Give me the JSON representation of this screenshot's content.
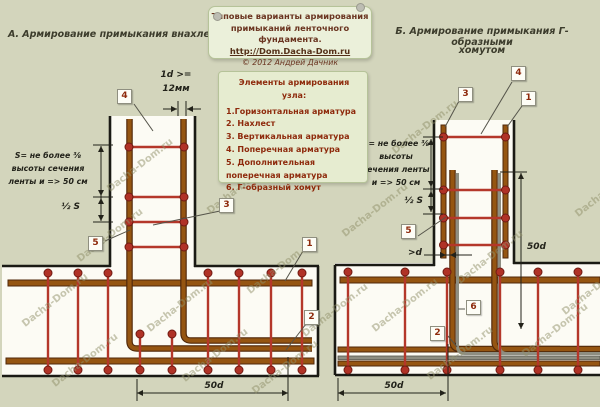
{
  "page": {
    "watermark": "Dacha-Dom.ru"
  },
  "note": {
    "line1": "Типовые варианты армирования",
    "line2": "примыканий ленточного фундамента.",
    "link": "http://Dom.Dacha-Dom.ru",
    "copyright": "© 2012 Андрей Дачник"
  },
  "titles": {
    "left": "А. Армирование примыкания внахлест",
    "right_line1": "Б. Армирование примыкания  Г- образными",
    "right_line2": "хомутом"
  },
  "legend": {
    "header": "Элементы армирования узла:",
    "items": [
      "1.Горизонтальная арматура",
      "2. Нахлест",
      "3. Вертикальная арматура",
      "4. Поперечная арматура",
      "5. Дополнительная поперечная арматура",
      "6. Г-образный хомут"
    ]
  },
  "left_diagram": {
    "bar_dia_line1": "1d >=",
    "bar_dia_line2": "12мм",
    "s_note_lines": [
      "S= не более ⅜",
      "высоты сечения",
      "ленты и => 50 см"
    ],
    "half_s": "½ S",
    "overlap_dim": "50d",
    "callouts": {
      "c4": "4",
      "c3": "3",
      "c5": "5",
      "c1": "1",
      "c2": "2"
    }
  },
  "right_diagram": {
    "s_note_lines": [
      "S= не более ⅜",
      "высоты",
      "сечения ленты",
      "и => 50 см"
    ],
    "half_s": "½ S",
    "gap_dim": ">d",
    "hook_len": "50d",
    "overlap_dim": "50d",
    "callouts": {
      "c3": "3",
      "c4": "4",
      "c1": "1",
      "c5": "5",
      "c6": "6",
      "c2": "2"
    }
  },
  "colors": {
    "ground": "#d3d5bc",
    "concrete": "#fcfbf4",
    "line": "#1a1a14",
    "brown": "#955511",
    "browndk": "#50280a",
    "red": "#b4372a",
    "dot": "#b03226",
    "dotbd": "#701a12",
    "gray": "#8e8e82",
    "maroon": "#8e2a0c",
    "notebg": "#ebf0da",
    "notebd": "#b6c399",
    "title": "#3c3c2c",
    "dim": "#22221a",
    "wm": "#91916a"
  }
}
